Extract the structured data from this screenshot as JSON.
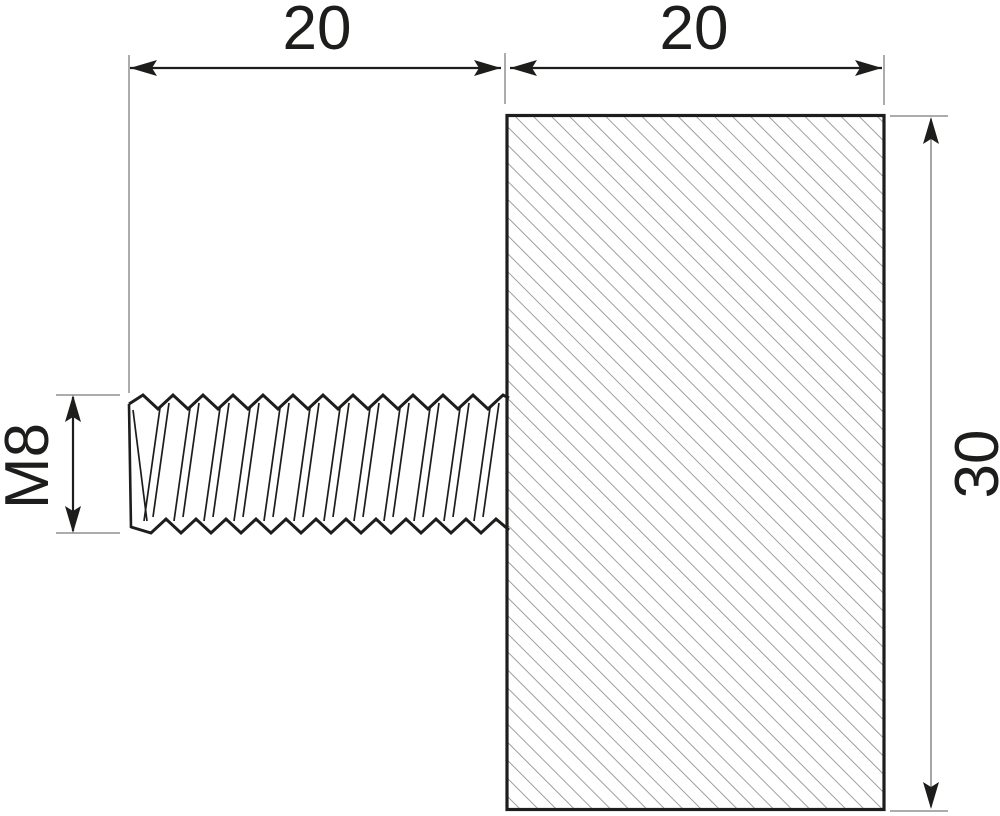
{
  "drawing": {
    "description": "Dimensioned side-view technical drawing of an M8 threaded stud attached to a rectangular hatched body",
    "labels": {
      "thread_length": "20",
      "body_width": "20",
      "body_height": "30",
      "thread_designation": "M8"
    },
    "colors": {
      "line": "#1d1d1b",
      "extension": "#909090",
      "hatch": "#8f8f8f",
      "height_dim_line": "#9c9c9c",
      "background": "#ffffff"
    }
  }
}
